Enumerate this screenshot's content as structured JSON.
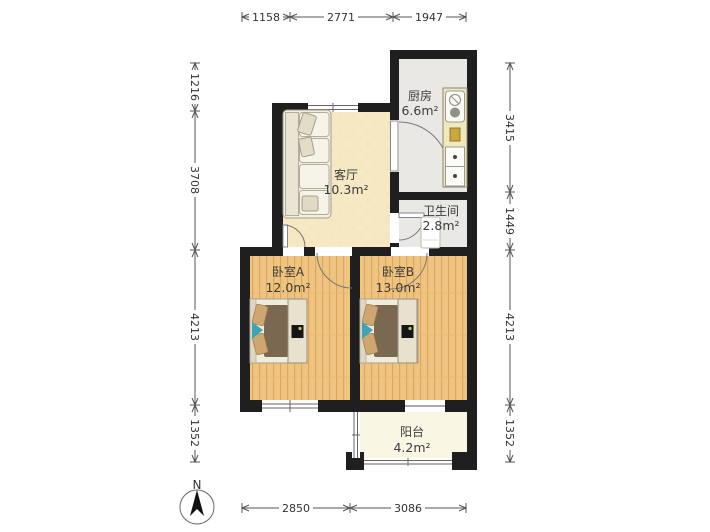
{
  "rooms": {
    "kitchen": {
      "name": "厨房",
      "area": "6.6m²"
    },
    "living": {
      "name": "客厅",
      "area": "10.3m²"
    },
    "bathroom": {
      "name": "卫生间",
      "area": "2.8m²"
    },
    "bedroom_a": {
      "name": "卧室A",
      "area": "12.0m²"
    },
    "bedroom_b": {
      "name": "卧室B",
      "area": "13.0m²"
    },
    "balcony": {
      "name": "阳台",
      "area": "4.2m²"
    }
  },
  "dims": {
    "top": [
      "1158",
      "2771",
      "1947"
    ],
    "left": [
      "1216",
      "3708",
      "4213",
      "1352"
    ],
    "right": [
      "3415",
      "1449",
      "4213",
      "1352"
    ],
    "bottom": [
      "2850",
      "3086"
    ]
  },
  "compass": {
    "label": "N"
  },
  "colors": {
    "wall": "#1f1f1f",
    "living_floor": "#f5e8c3",
    "tile_floor": "#e9e8e4",
    "balcony_floor": "#f9f6e4",
    "wood_base": "#efc480",
    "wood_grain": "#dda75e",
    "duvet": "#7b6850",
    "pillow": "#cda671",
    "accent_teal": "#3fa3b4",
    "counter": "#f1e8bc",
    "tv_green": "#a9d14e"
  }
}
